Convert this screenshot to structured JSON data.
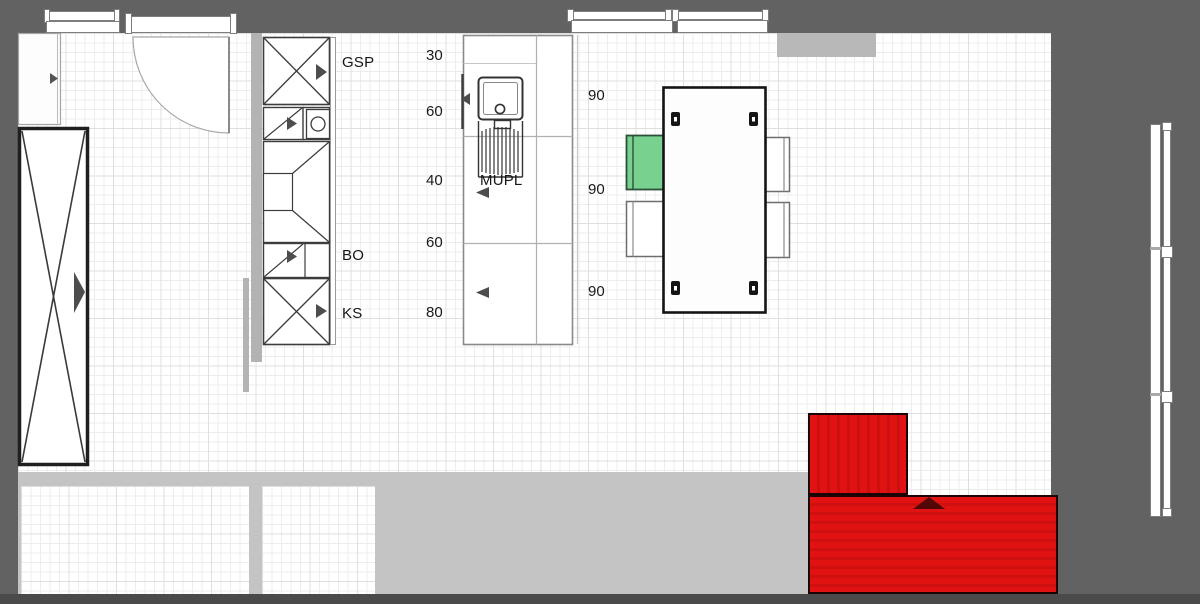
{
  "plan_labels": {
    "gsp": "GSP",
    "bo": "BO",
    "ks": "KS",
    "mupl": "MUPL"
  },
  "dimension_labels": {
    "col": [
      "30",
      "60",
      "40",
      "60",
      "80"
    ],
    "right": [
      "90",
      "90",
      "90"
    ]
  },
  "colors": {
    "background_gray": "#626262",
    "wall_gray": "#b3b3b3",
    "walkway_gray": "#c4c4c4",
    "bottom_bar_gray": "#4a4a4a",
    "floor_white": "#ffffff",
    "chair_accent_green": "#79d18f",
    "sofa_red": "#e11212"
  }
}
